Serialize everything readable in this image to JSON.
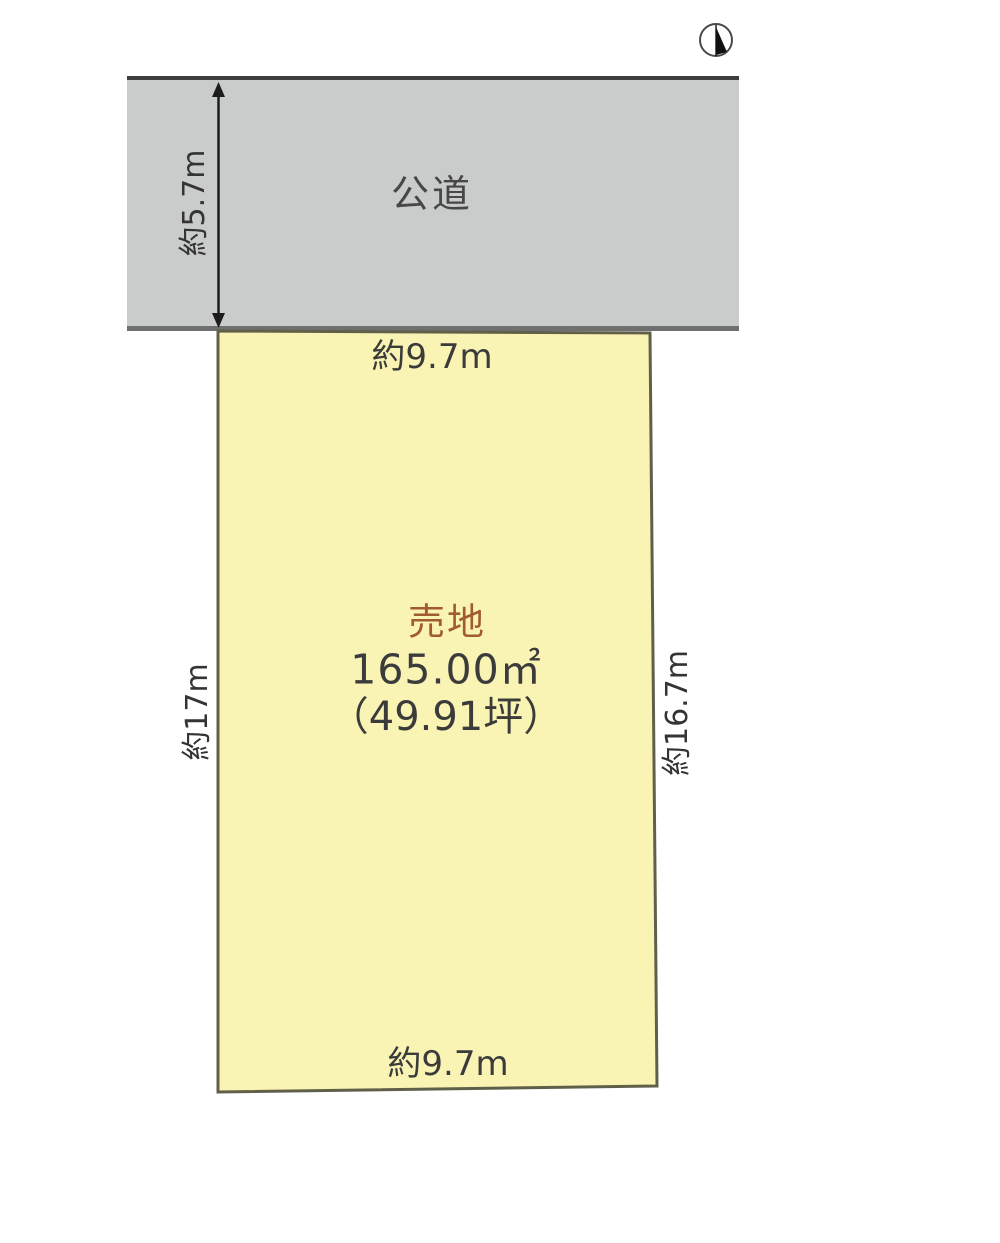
{
  "compass": {
    "name": "north-indicator"
  },
  "road": {
    "name_label": "公道",
    "width_label": "約5.7m"
  },
  "plot": {
    "sale_label": "売地",
    "area_sqm": "165.00㎡",
    "area_tsubo": "（49.91坪）",
    "frontage_top": "約9.7m",
    "frontage_bottom": "約9.7m",
    "depth_left": "約17m",
    "depth_right": "約16.7m"
  },
  "colors": {
    "road_fill": "#c9cccb",
    "road_border_top": "#3e3e3e",
    "road_border_bottom": "#6f6f6f",
    "plot_fill": "#f9f4b3",
    "plot_border": "#60604a",
    "sale_text": "#a25a32",
    "text": "#3b3b3b",
    "arrow": "#1c1c1c"
  }
}
